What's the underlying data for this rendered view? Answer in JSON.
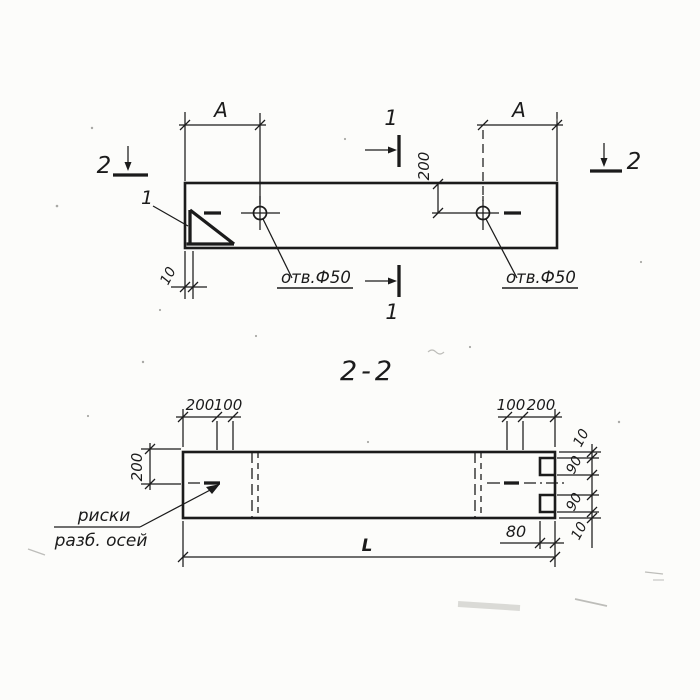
{
  "plan": {
    "dim_a": "A",
    "dim_200": "200",
    "dim_10": "10",
    "hole_label": "отв.Ф50",
    "detail_callout": "1",
    "section_mark_1": "1",
    "section_mark_2": "2"
  },
  "section": {
    "title": "2-2",
    "dim_200": "200",
    "dim_100": "100",
    "dim_90": "90",
    "dim_10": "10",
    "dim_80": "80",
    "dim_length": "L",
    "axis_note_line1": "риски",
    "axis_note_line2": "разб. осей"
  },
  "colors": {
    "ink": "#1b1b1b",
    "paper": "#fcfcfa"
  }
}
